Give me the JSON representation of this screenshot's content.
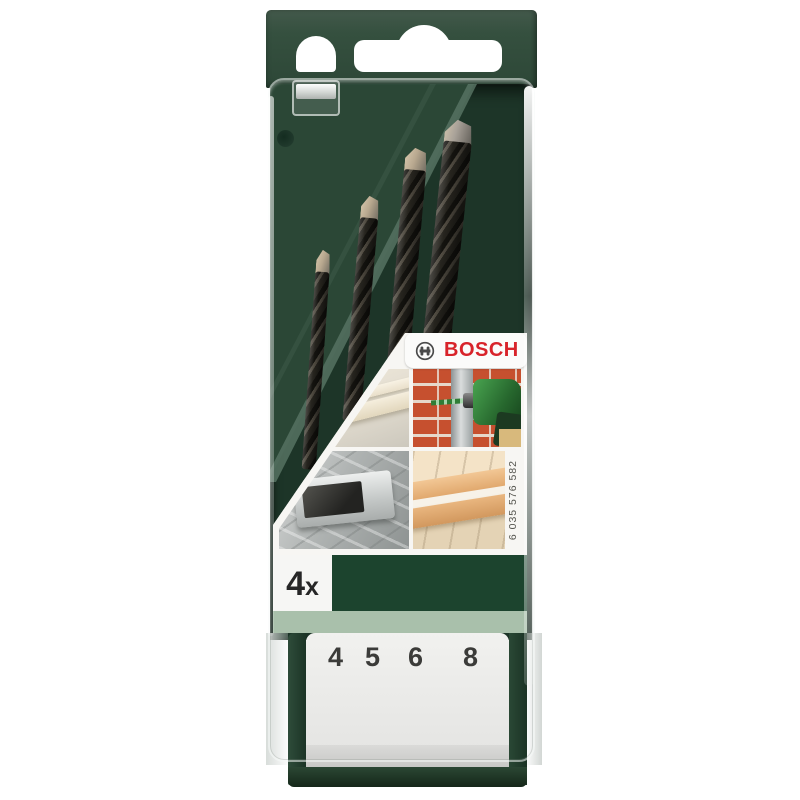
{
  "brand": {
    "name": "BOSCH",
    "color": "#d8232a",
    "logo_icon": "bosch-armature"
  },
  "label": {
    "quantity": {
      "number": "4",
      "suffix": "x"
    },
    "part_number": "6 035 576 582",
    "application_images": [
      "plastic-strips",
      "masonry-drilling",
      "checker-plate-metal",
      "wood-boards"
    ]
  },
  "drawer": {
    "sizes": [
      "4",
      "5",
      "6",
      "8"
    ]
  },
  "bits": {
    "count": 4
  },
  "colors": {
    "case_green": "#32503f",
    "interior_green": "#1d3528",
    "band_dark_green": "#1c442e",
    "band_sage": "#a9c0ab",
    "bosch_red": "#d8232a",
    "drawer_white": "#ececea"
  }
}
